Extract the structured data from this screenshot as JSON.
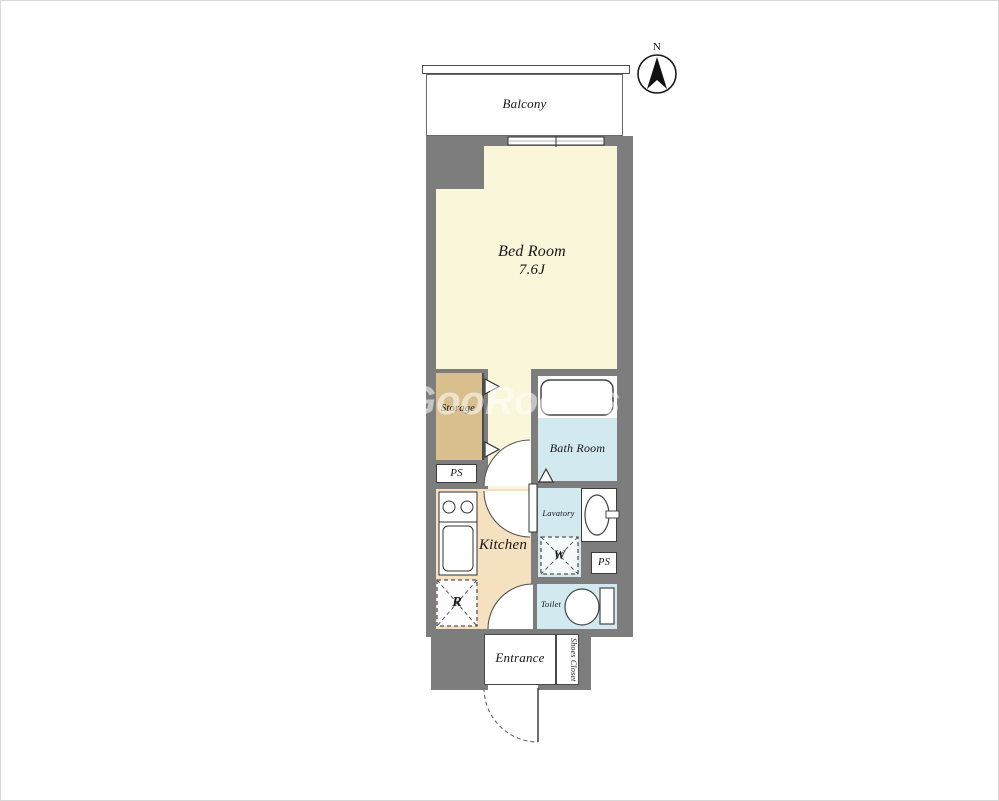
{
  "compass": {
    "north_label": "N"
  },
  "balcony": {
    "label": "Balcony"
  },
  "bedroom": {
    "label": "Bed Room",
    "size": "7.6J"
  },
  "storage": {
    "label": "Storage"
  },
  "ps_left": {
    "label": "PS"
  },
  "bath": {
    "label": "Bath Room"
  },
  "kitchen": {
    "label": "Kitchen"
  },
  "lavatory": {
    "label": "Lavatory"
  },
  "washer": {
    "label": "W"
  },
  "ps_right": {
    "label": "PS"
  },
  "toilet": {
    "label": "Toilet"
  },
  "fridge": {
    "label": "R"
  },
  "entrance": {
    "label": "Entrance"
  },
  "shoes_closet": {
    "label": "Shoes Closet"
  },
  "watermark": {
    "text": "GooRooms"
  },
  "colors": {
    "wall": "#7d7d7d",
    "bedroom": "#faf6da",
    "storage": "#d9be8e",
    "kitchen": "#f5e0bf",
    "wet_room": "#d2e9ef",
    "fixture_white": "#ffffff"
  }
}
